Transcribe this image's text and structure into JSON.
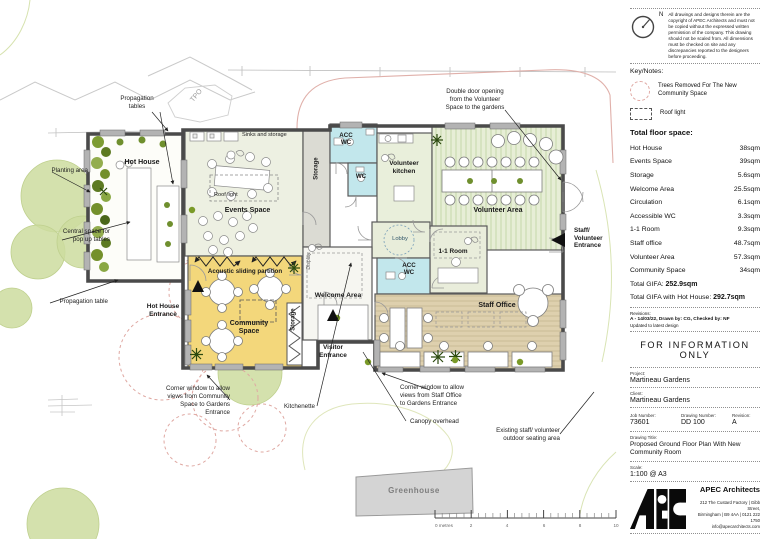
{
  "plan": {
    "rooms": {
      "hot_house": "Hot House",
      "events_space": "Events Space",
      "sinks_storage": "Sinks and storage",
      "roof_light": "Roof light",
      "storage_top": "Storage",
      "acc_wc_top": "ACC\nWC",
      "wc": "WC",
      "volunteer_kitchen": "Volunteer\nkitchen",
      "volunteer_area": "Volunteer Area",
      "lobby": "Lobby",
      "one_to_one_room": "1-1 Room",
      "acc_wc_mid": "ACC\nWC",
      "welcome_area": "Welcome Area",
      "display": "Display",
      "acoustic_partition": "Acoustic sliding partition",
      "community_space": "Community\nSpace",
      "storage_community": "Storage",
      "staff_office": "Staff Office",
      "greenhouse": "Greenhouse",
      "tpo": "TPO"
    },
    "entrances": {
      "hot_house": "Hot House\nEntrance",
      "visitor": "Visitor\nEntrance",
      "staff_volunteer": "Staff/\nVolunteer\nEntrance"
    },
    "annotations": {
      "propagation_tables": "Propagation\ntables",
      "planting_area": "Planting area",
      "central_space": "Central space for\npop up tables",
      "propagation_table": "Propagation table",
      "double_door": "Double door opening\nfrom the Volunteer\nSpace to the gardens",
      "corner_window_community": "Corner window to allow\nviews from Community\nSpace to Gardens\nEntrance",
      "kitchenette": "Kitchenette",
      "corner_window_staff": "Corner window to allow\nviews from Staff Office\nto Gardens Entrance",
      "canopy": "Canopy overhead",
      "outdoor_seating": "Existing staff/ volunteer\noutdoor seating area"
    },
    "scale_bar": {
      "labels": [
        "0 metres",
        "2",
        "4",
        "6",
        "8",
        "10"
      ]
    }
  },
  "panel": {
    "north_label": "N",
    "copyright": "All drawings and designs therein are the copyright of APEC Architects and must not be copied without the expressed written permission of the company. This drawing should not be scaled from. All dimensions must be checked on site and any discrepancies reported to the designers before proceeding.",
    "key_notes_heading": "Key/Notes:",
    "key_tree_label": "Trees Removed For The New\nCommunity Space",
    "key_rooflight_label": "Roof light",
    "floor_space_heading": "Total floor space:",
    "floor_space_rows": [
      {
        "name": "Hot House",
        "area": "38sqm"
      },
      {
        "name": "Events Space",
        "area": "39sqm"
      },
      {
        "name": "Storage",
        "area": "5.6sqm"
      },
      {
        "name": "Welcome Area",
        "area": "25.5sqm"
      },
      {
        "name": "Circulation",
        "area": "6.1sqm"
      },
      {
        "name": "Accessible WC",
        "area": "3.3sqm"
      },
      {
        "name": "1-1 Room",
        "area": "9.3sqm"
      },
      {
        "name": "Staff office",
        "area": "48.7sqm"
      },
      {
        "name": "Volunteer Area",
        "area": "57.3sqm"
      },
      {
        "name": "Community Space",
        "area": "34sqm"
      }
    ],
    "total_gifa_label": "Total GIFA:",
    "total_gifa_value": "252.9sqm",
    "total_gifa_hh_label": "Total GIFA with Hot House:",
    "total_gifa_hh_value": "292.7sqm",
    "revisions_heading": "Revisions:",
    "revision_entry": "A     -     14/03/22, Drawn by: CG, Checked by: NF",
    "revision_note": "Updated to latest design",
    "status": "FOR  INFORMATION  ONLY",
    "project_label": "Project:",
    "project_value": "Martineau Gardens",
    "client_label": "Client:",
    "client_value": "Martineau Gardens",
    "job_number_label": "Job Number:",
    "job_number_value": "73601",
    "drawing_number_label": "Drawing Number:",
    "drawing_number_value": "DD 100",
    "revision_label": "Revision:",
    "revision_value": "A",
    "drawing_title_label": "Drawing Title:",
    "drawing_title_value": "Proposed Ground Floor Plan With New Community Room",
    "scale_label": "Scale:",
    "scale_value": "1:100 @ A3",
    "firm_name": "APEC Architects",
    "firm_address": "212 The Custard Factory | Gibb Street,\nBirmingham | B9 4AA | 0121 222 1750\ninfo@apecarchitects.com"
  }
}
